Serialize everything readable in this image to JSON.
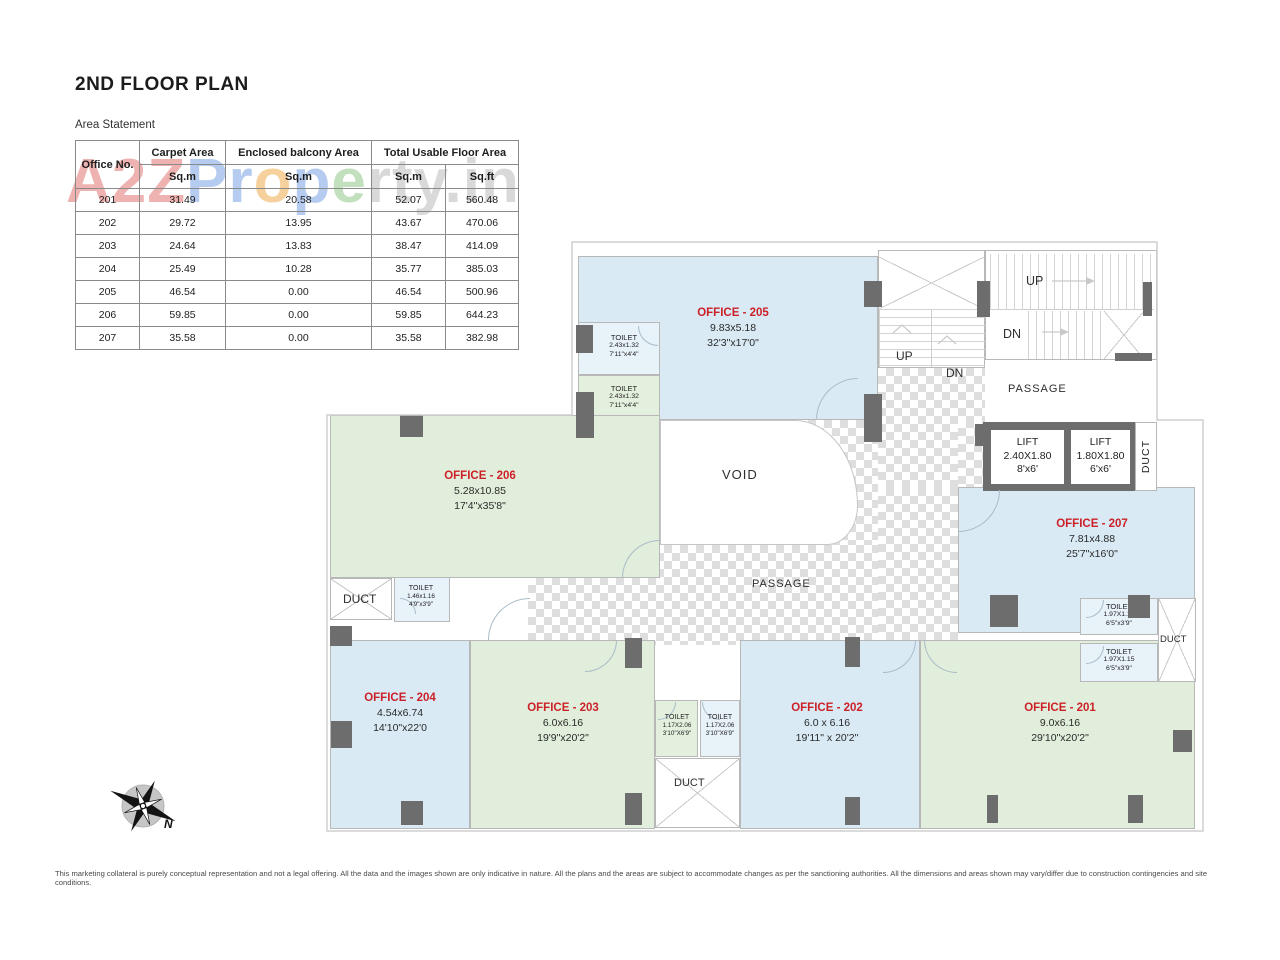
{
  "colors": {
    "office_blue": "#d9eaf5",
    "office_green": "#e1eedb",
    "label_red": "#cc2128",
    "wall_dark": "#6d6d6d",
    "checker_gray": "#dedede"
  },
  "header": {
    "title": "2ND FLOOR PLAN"
  },
  "watermark": {
    "p1": "A2Z",
    "p2": "Pr",
    "p3": "o",
    "p4": "p",
    "p5": "e",
    "p6": "rty.in"
  },
  "area_statement": {
    "title": "Area Statement",
    "col_office": "Office No.",
    "col_carpet": "Carpet Area",
    "col_balcony": "Enclosed balcony Area",
    "col_total": "Total Usable Floor Area",
    "unit_sqm": "Sq.m",
    "unit_sqft": "Sq.ft",
    "rows": [
      {
        "office": "201",
        "carpet": "31.49",
        "balcony": "20.58",
        "total_sqm": "52.07",
        "total_sqft": "560.48"
      },
      {
        "office": "202",
        "carpet": "29.72",
        "balcony": "13.95",
        "total_sqm": "43.67",
        "total_sqft": "470.06"
      },
      {
        "office": "203",
        "carpet": "24.64",
        "balcony": "13.83",
        "total_sqm": "38.47",
        "total_sqft": "414.09"
      },
      {
        "office": "204",
        "carpet": "25.49",
        "balcony": "10.28",
        "total_sqm": "35.77",
        "total_sqft": "385.03"
      },
      {
        "office": "205",
        "carpet": "46.54",
        "balcony": "0.00",
        "total_sqm": "46.54",
        "total_sqft": "500.96"
      },
      {
        "office": "206",
        "carpet": "59.85",
        "balcony": "0.00",
        "total_sqm": "59.85",
        "total_sqft": "644.23"
      },
      {
        "office": "207",
        "carpet": "35.58",
        "balcony": "0.00",
        "total_sqm": "35.58",
        "total_sqft": "382.98"
      }
    ]
  },
  "plan": {
    "offices": [
      {
        "name": "OFFICE - 205",
        "dim_m": "9.83x5.18",
        "dim_ft": "32'3\"x17'0\""
      },
      {
        "name": "OFFICE - 206",
        "dim_m": "5.28x10.85",
        "dim_ft": "17'4\"x35'8\""
      },
      {
        "name": "OFFICE - 207",
        "dim_m": "7.81x4.88",
        "dim_ft": "25'7\"x16'0\""
      },
      {
        "name": "OFFICE - 204",
        "dim_m": "4.54x6.74",
        "dim_ft": "14'10\"x22'0"
      },
      {
        "name": "OFFICE - 203",
        "dim_m": "6.0x6.16",
        "dim_ft": "19'9\"x20'2\""
      },
      {
        "name": "OFFICE - 202",
        "dim_m": "6.0 x 6.16",
        "dim_ft": "19'11\" x 20'2\""
      },
      {
        "name": "OFFICE - 201",
        "dim_m": "9.0x6.16",
        "dim_ft": "29'10\"x20'2\""
      }
    ],
    "toilets": [
      {
        "name": "TOILET",
        "dim_m": "2.43x1.32",
        "dim_ft": "7'11\"x4'4\""
      },
      {
        "name": "TOILET",
        "dim_m": "1.46x1.16",
        "dim_ft": "4'9\"x3'9\""
      },
      {
        "name": "TOILET",
        "dim_m": "1.17X2.06",
        "dim_ft": "3'10\"X6'9\""
      },
      {
        "name": "TOILET",
        "dim_m": "1.97X1.15",
        "dim_ft": "6'5\"x3'9\""
      }
    ],
    "lifts": [
      {
        "name": "LIFT",
        "dim_m": "2.40X1.80",
        "dim_ft": "8'x6'"
      },
      {
        "name": "LIFT",
        "dim_m": "1.80X1.80",
        "dim_ft": "6'x6'"
      }
    ],
    "labels": {
      "void": "VOID",
      "passage": "PASSAGE",
      "duct": "DUCT",
      "up": "UP",
      "dn": "DN",
      "north": "N"
    }
  },
  "footer": {
    "disclaimer": "This marketing collateral is purely conceptual representation and not a legal offering. All the data and the images shown are only indicative in nature. All the plans and the areas are subject to accommodate changes as per the sanctioning authorities. All the dimensions and areas shown may vary/differ due to construction contingencies and site conditions."
  }
}
